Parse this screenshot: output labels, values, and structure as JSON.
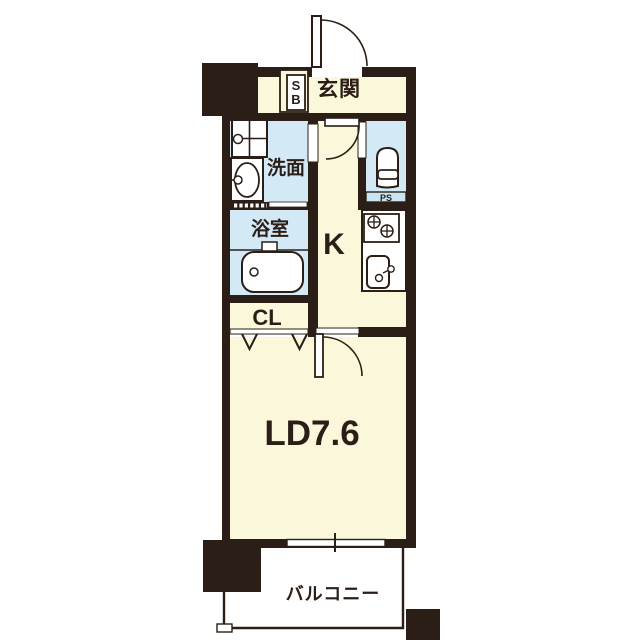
{
  "title": "1K apartment floor plan",
  "colors": {
    "wall": "#2b1e16",
    "floor_cream": "#fbf7db",
    "floor_wet_blue": "#d3e9f5",
    "fixture_white": "#ffffff"
  },
  "rooms": {
    "entrance": {
      "label": "玄関"
    },
    "shoe_box": {
      "label_top": "S",
      "label_bottom": "B"
    },
    "washroom": {
      "label": "洗面"
    },
    "bathroom": {
      "label": "浴室"
    },
    "kitchen": {
      "label": "K"
    },
    "pipe_space": {
      "label": "PS"
    },
    "closet": {
      "label": "CL"
    },
    "living_dining": {
      "label": "LD7.6"
    },
    "balcony": {
      "label": "バルコニー"
    }
  },
  "icons": {
    "entrance_door": "quarter-arc swing door",
    "hall_door": "quarter-arc swing door",
    "ld_door": "quarter-arc swing door",
    "closet_door": "folding door chevrons",
    "window": "sliding window",
    "washer_pan": "washing machine pan",
    "vanity_sink": "wash basin",
    "bathtub": "bathtub",
    "toilet": "toilet",
    "stove": "two-burner stove",
    "kitchen_sink": "kitchen sink"
  }
}
